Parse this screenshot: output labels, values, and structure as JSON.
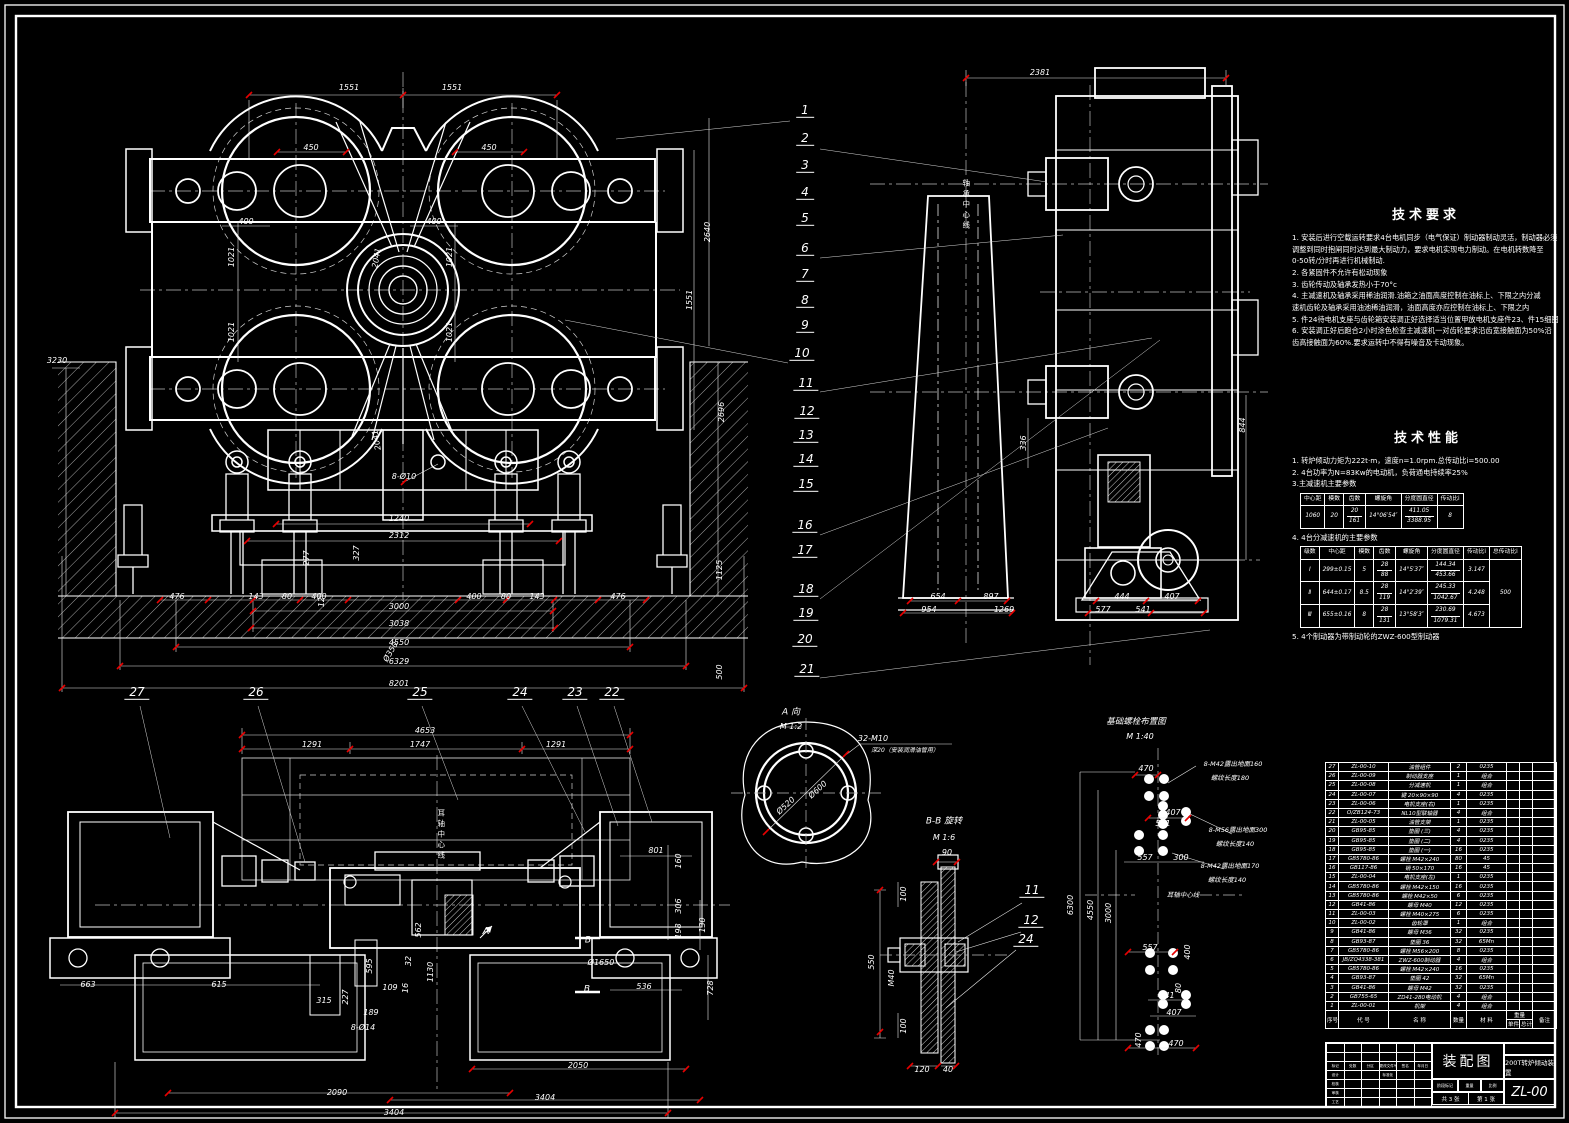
{
  "sheet": {
    "title": "装配图",
    "product": "200T转炉倾动装置",
    "code": "ZL-00",
    "sheet_count": "共 3 张",
    "sheet_no": "第 1 张"
  },
  "tech_requirements": {
    "title": "技术要求",
    "lines": [
      "1. 安装后进行空载运转要求4台电机同步（电气保证）制动器制动灵活，制动器必须",
      "    调整到同时抱闸同时达到最大制动力，要求电机实现电力制动。在电机转数降至",
      "      0-50转/分时再进行机械制动.",
      "2. 各紧固件不允许有松动现象",
      "3. 齿轮传动及轴承发热小于70°c",
      "4. 主减速机及轴承采用稀油润滑.油箱之油面高度控制在油标上、下限之内分减",
      "    速机齿轮及轴承采用油池稀油润滑，油面高度亦应控制在油标上、下限之内",
      "5. 件24待电机支座与齿轮箱安装调正好选择适当位置甲放电机支座件23、件15细图",
      "6. 安装调正好后跑合2小时涂色检查主减速机一对齿轮要求沿齿宽接触面为50%沿",
      "    齿高接触面为60%.要求运转中不得有噪音及卡动现象。"
    ]
  },
  "tech_performance": {
    "title": "技术性能",
    "line1": "1. 转炉倾动力矩为222t·m，速度n=1.0rpm.总传动比i=500.00",
    "line2": "2. 4台功率为N=83Kw的电动机，负荷通电持续率25%",
    "line3": "3.主减速机主要参数",
    "line4": "4. 4台分减速机的主要参数",
    "line5": "5. 4个制动器为带制动轮的ZWZ-600型制动器",
    "table1": {
      "h": [
        "中心距",
        "模数",
        "齿数",
        "螺旋角",
        "分度圆直径",
        "传动比i"
      ],
      "center": "1060",
      "module": "20",
      "teeth_top": "20",
      "teeth_bot": "161",
      "angle": "14°06′54″",
      "dia_top": "411.05",
      "dia_bot": "3388.95",
      "ratio": "8"
    },
    "table2": {
      "h": [
        "级数",
        "中心距",
        "模数",
        "齿数",
        "螺旋角",
        "分度圆直径",
        "传动比i",
        "总传动比i"
      ],
      "rows": [
        {
          "stage": "Ⅰ",
          "center": "299±0.15",
          "module": "5",
          "teeth_top": "28",
          "teeth_bot": "88",
          "angle": "14°5′37″",
          "dia_top": "144.34",
          "dia_bot": "453.66",
          "ratio": "3.147"
        },
        {
          "stage": "Ⅱ",
          "center": "644±0.17",
          "module": "8.5",
          "teeth_top": "28",
          "teeth_bot": "119",
          "angle": "14°2′39″",
          "dia_top": "245.33",
          "dia_bot": "1042.67",
          "ratio": "4.248"
        },
        {
          "stage": "Ⅲ",
          "center": "655±0.16",
          "module": "8",
          "teeth_top": "28",
          "teeth_bot": "131",
          "angle": "13°58′3″",
          "dia_top": "230.69",
          "dia_bot": "1079.31",
          "ratio": "4.673"
        }
      ],
      "total_ratio": "500"
    }
  },
  "labels": {
    "front": [
      {
        "t": "1551",
        "x": 349,
        "y": 88
      },
      {
        "t": "1551",
        "x": 452,
        "y": 88
      },
      {
        "t": "450",
        "x": 311,
        "y": 148
      },
      {
        "t": "450",
        "x": 489,
        "y": 148
      },
      {
        "t": "400",
        "x": 246,
        "y": 222
      },
      {
        "t": "400",
        "x": 434,
        "y": 222
      },
      {
        "t": "1021",
        "x": 232,
        "y": 257,
        "r": -90
      },
      {
        "t": "1021",
        "x": 450,
        "y": 257,
        "r": -90
      },
      {
        "t": "1021",
        "x": 232,
        "y": 332,
        "r": -90
      },
      {
        "t": "1021",
        "x": 450,
        "y": 332,
        "r": -90
      },
      {
        "t": "2041",
        "x": 377,
        "y": 258,
        "r": -80
      },
      {
        "t": "2041",
        "x": 377,
        "y": 440,
        "r": -100
      },
      {
        "t": "2640",
        "x": 708,
        "y": 232,
        "r": -90
      },
      {
        "t": "1551",
        "x": 690,
        "y": 300,
        "r": -90
      },
      {
        "t": "3230",
        "x": 57,
        "y": 361
      },
      {
        "t": "2696",
        "x": 722,
        "y": 412,
        "r": -90
      },
      {
        "t": "1125",
        "x": 720,
        "y": 570,
        "r": -90
      },
      {
        "t": "500",
        "x": 720,
        "y": 672,
        "r": -90
      },
      {
        "t": "8-Ø10",
        "x": 404,
        "y": 477
      },
      {
        "t": "327",
        "x": 357,
        "y": 553,
        "r": -90
      },
      {
        "t": "277",
        "x": 307,
        "y": 558,
        "r": -90
      },
      {
        "t": "12",
        "x": 322,
        "y": 602,
        "r": -90
      },
      {
        "t": "Ø350",
        "x": 391,
        "y": 652,
        "r": -60
      },
      {
        "t": "1240",
        "x": 399,
        "y": 519
      },
      {
        "t": "2312",
        "x": 399,
        "y": 536
      },
      {
        "t": "476",
        "x": 177,
        "y": 597
      },
      {
        "t": "143",
        "x": 256,
        "y": 597
      },
      {
        "t": "80",
        "x": 287,
        "y": 597
      },
      {
        "t": "400",
        "x": 319,
        "y": 597
      },
      {
        "t": "400",
        "x": 474,
        "y": 597
      },
      {
        "t": "80",
        "x": 506,
        "y": 597
      },
      {
        "t": "143",
        "x": 537,
        "y": 597
      },
      {
        "t": "476",
        "x": 618,
        "y": 597
      },
      {
        "t": "3000",
        "x": 399,
        "y": 607
      },
      {
        "t": "3038",
        "x": 399,
        "y": 624
      },
      {
        "t": "4550",
        "x": 399,
        "y": 643
      },
      {
        "t": "6329",
        "x": 399,
        "y": 662
      },
      {
        "t": "8201",
        "x": 399,
        "y": 684
      }
    ],
    "side": [
      {
        "t": "2381",
        "x": 1040,
        "y": 73
      },
      {
        "t": "轴承中心线",
        "x": 966,
        "y": 205,
        "v": 1
      },
      {
        "t": "336",
        "x": 1024,
        "y": 443,
        "r": -90
      },
      {
        "t": "844",
        "x": 1243,
        "y": 425,
        "r": -90
      },
      {
        "t": "654",
        "x": 938,
        "y": 597
      },
      {
        "t": "897",
        "x": 991,
        "y": 597
      },
      {
        "t": "954",
        "x": 929,
        "y": 610
      },
      {
        "t": "1269",
        "x": 1004,
        "y": 610
      },
      {
        "t": "444",
        "x": 1122,
        "y": 597
      },
      {
        "t": "407",
        "x": 1172,
        "y": 597
      },
      {
        "t": "577",
        "x": 1103,
        "y": 610
      },
      {
        "t": "541",
        "x": 1143,
        "y": 610
      }
    ],
    "plan": [
      {
        "t": "4653",
        "x": 425,
        "y": 731
      },
      {
        "t": "1291",
        "x": 312,
        "y": 745
      },
      {
        "t": "1747",
        "x": 420,
        "y": 745
      },
      {
        "t": "1291",
        "x": 556,
        "y": 745
      },
      {
        "t": "801",
        "x": 656,
        "y": 851
      },
      {
        "t": "耳轴中心线",
        "x": 441,
        "y": 835,
        "v": 1
      },
      {
        "t": "A",
        "x": 486,
        "y": 932,
        "s": 10
      },
      {
        "t": "B",
        "x": 588,
        "y": 941,
        "s": 9
      },
      {
        "t": "B",
        "x": 587,
        "y": 990,
        "s": 9
      },
      {
        "t": "160",
        "x": 679,
        "y": 861,
        "r": -90
      },
      {
        "t": "306",
        "x": 679,
        "y": 906,
        "r": -90
      },
      {
        "t": "198",
        "x": 679,
        "y": 931,
        "r": -90
      },
      {
        "t": "130",
        "x": 703,
        "y": 925,
        "r": -90
      },
      {
        "t": "728",
        "x": 711,
        "y": 988,
        "r": -90
      },
      {
        "t": "536",
        "x": 644,
        "y": 987
      },
      {
        "t": "Ø1650",
        "x": 601,
        "y": 963
      },
      {
        "t": "663",
        "x": 88,
        "y": 985
      },
      {
        "t": "615",
        "x": 219,
        "y": 985
      },
      {
        "t": "595",
        "x": 370,
        "y": 966,
        "r": -90
      },
      {
        "t": "315",
        "x": 324,
        "y": 1001
      },
      {
        "t": "227",
        "x": 346,
        "y": 997,
        "r": -90
      },
      {
        "t": "189",
        "x": 371,
        "y": 1013
      },
      {
        "t": "8-Ø14",
        "x": 363,
        "y": 1028
      },
      {
        "t": "109",
        "x": 390,
        "y": 988
      },
      {
        "t": "32",
        "x": 409,
        "y": 961,
        "r": -90
      },
      {
        "t": "16",
        "x": 406,
        "y": 988,
        "r": -90
      },
      {
        "t": "1130",
        "x": 431,
        "y": 972,
        "r": -90
      },
      {
        "t": "562",
        "x": 419,
        "y": 930,
        "r": -90
      },
      {
        "t": "2090",
        "x": 337,
        "y": 1093
      },
      {
        "t": "3404",
        "x": 394,
        "y": 1113
      },
      {
        "t": "2050",
        "x": 578,
        "y": 1066
      },
      {
        "t": "3404",
        "x": 545,
        "y": 1098
      }
    ],
    "aview": [
      {
        "t": "A 向",
        "x": 791,
        "y": 713,
        "s": 9
      },
      {
        "t": "M 1:2",
        "x": 791,
        "y": 727
      },
      {
        "t": "32-M10",
        "x": 873,
        "y": 739
      },
      {
        "t": "深20（安装润滑油管用）",
        "x": 905,
        "y": 751,
        "s": 6
      },
      {
        "t": "Ø520",
        "x": 786,
        "y": 806,
        "r": -42
      },
      {
        "t": "Ø600",
        "x": 818,
        "y": 790,
        "r": -42
      }
    ],
    "bb": [
      {
        "t": "B-B 旋转",
        "x": 944,
        "y": 822,
        "s": 9
      },
      {
        "t": "M 1:6",
        "x": 944,
        "y": 838
      },
      {
        "t": "90",
        "x": 947,
        "y": 853
      },
      {
        "t": "100",
        "x": 904,
        "y": 894,
        "r": -90
      },
      {
        "t": "550",
        "x": 872,
        "y": 962,
        "r": -90
      },
      {
        "t": "M40",
        "x": 892,
        "y": 978,
        "r": -90
      },
      {
        "t": "100",
        "x": 904,
        "y": 1026,
        "r": -90
      },
      {
        "t": "120",
        "x": 922,
        "y": 1070
      },
      {
        "t": "40",
        "x": 948,
        "y": 1070
      }
    ],
    "foundation": [
      {
        "t": "基础螺栓布置图",
        "x": 1136,
        "y": 722,
        "s": 8.5
      },
      {
        "t": "M 1:40",
        "x": 1140,
        "y": 737
      },
      {
        "t": "470",
        "x": 1146,
        "y": 769
      },
      {
        "t": "8-M42露出地面160",
        "x": 1233,
        "y": 764,
        "s": 6.5
      },
      {
        "t": "螺纹长度180",
        "x": 1230,
        "y": 778,
        "s": 6.5
      },
      {
        "t": "407",
        "x": 1173,
        "y": 813
      },
      {
        "t": "541",
        "x": 1163,
        "y": 824
      },
      {
        "t": "8-M56露出地面300",
        "x": 1238,
        "y": 830,
        "s": 6.5
      },
      {
        "t": "螺纹长度140",
        "x": 1235,
        "y": 844,
        "s": 6.5
      },
      {
        "t": "557",
        "x": 1145,
        "y": 858
      },
      {
        "t": "300",
        "x": 1181,
        "y": 858
      },
      {
        "t": "8-M42露出地面170",
        "x": 1230,
        "y": 866,
        "s": 6.5
      },
      {
        "t": "螺纹长度140",
        "x": 1227,
        "y": 880,
        "s": 6.5
      },
      {
        "t": "耳轴中心线",
        "x": 1183,
        "y": 895,
        "s": 6.5
      },
      {
        "t": "6300",
        "x": 1071,
        "y": 905,
        "r": -90
      },
      {
        "t": "4550",
        "x": 1091,
        "y": 910,
        "r": -90
      },
      {
        "t": "3000",
        "x": 1109,
        "y": 913,
        "r": -90
      },
      {
        "t": "557",
        "x": 1150,
        "y": 948
      },
      {
        "t": "400",
        "x": 1188,
        "y": 952,
        "r": -90
      },
      {
        "t": "80",
        "x": 1179,
        "y": 988,
        "r": -90
      },
      {
        "t": "541",
        "x": 1167,
        "y": 996
      },
      {
        "t": "407",
        "x": 1174,
        "y": 1013
      },
      {
        "t": "470",
        "x": 1139,
        "y": 1040,
        "r": -90
      },
      {
        "t": "470",
        "x": 1176,
        "y": 1044
      }
    ]
  },
  "callouts": {
    "main": [
      [
        1,
        805,
        118
      ],
      [
        2,
        805,
        146
      ],
      [
        3,
        805,
        173
      ],
      [
        4,
        805,
        200
      ],
      [
        5,
        805,
        226
      ],
      [
        6,
        805,
        256
      ],
      [
        7,
        805,
        282
      ],
      [
        8,
        805,
        308
      ],
      [
        9,
        805,
        333
      ],
      [
        10,
        802,
        361
      ],
      [
        11,
        806,
        391
      ],
      [
        12,
        807,
        419
      ],
      [
        13,
        806,
        443
      ],
      [
        14,
        806,
        467
      ],
      [
        15,
        806,
        492
      ],
      [
        16,
        805,
        533
      ],
      [
        17,
        805,
        558
      ],
      [
        18,
        806,
        597
      ],
      [
        19,
        806,
        621
      ],
      [
        20,
        805,
        647
      ],
      [
        21,
        807,
        677
      ]
    ],
    "plan": [
      [
        27,
        137,
        700
      ],
      [
        26,
        256,
        700
      ],
      [
        25,
        420,
        700
      ],
      [
        24,
        520,
        700
      ],
      [
        23,
        575,
        700
      ],
      [
        22,
        612,
        700
      ]
    ],
    "bb": [
      [
        11,
        1032,
        898
      ],
      [
        12,
        1031,
        928
      ],
      [
        24,
        1026,
        947
      ]
    ]
  },
  "bom": {
    "headers": {
      "no": "序号",
      "code": "代 号",
      "name": "名 称",
      "qty": "数量",
      "material": "材 料",
      "weight": "重量",
      "unit": "单件",
      "total": "总计",
      "remark": "备注"
    },
    "rows": [
      [
        "27",
        "ZL-00-10",
        "油管组件",
        "2",
        "0235"
      ],
      [
        "26",
        "ZL-00-09",
        "制动器支座",
        "1",
        "组合"
      ],
      [
        "25",
        "ZL-00-08",
        "分减速机",
        "1",
        "组合"
      ],
      [
        "24",
        "ZL-00-07",
        "键 20×90×90",
        "4",
        "0235"
      ],
      [
        "23",
        "ZL-00-06",
        "电机支座(右)",
        "1",
        "0235"
      ],
      [
        "22",
        "O/ZB124-73",
        "NL10型联轴器",
        "4",
        "组合"
      ],
      [
        "21",
        "ZL-00-05",
        "油管支架",
        "1",
        "0235"
      ],
      [
        "20",
        "GB95-85",
        "垫圈 (三)",
        "4",
        "0235"
      ],
      [
        "19",
        "GB95-85",
        "垫圈 (二)",
        "4",
        "0235"
      ],
      [
        "18",
        "GB95-85",
        "垫圈 (一)",
        "16",
        "0235"
      ],
      [
        "17",
        "GB5780-86",
        "螺栓 M42×240",
        "80",
        "45"
      ],
      [
        "16",
        "GB117-86",
        "销 50×170",
        "16",
        "45"
      ],
      [
        "15",
        "ZL-00-04",
        "电机支座(左)",
        "1",
        "0235"
      ],
      [
        "14",
        "GB5780-86",
        "螺栓 M42×150",
        "16",
        "0235"
      ],
      [
        "13",
        "GB5780-86",
        "螺栓 M42×50",
        "6",
        "0235"
      ],
      [
        "12",
        "GB41-86",
        "螺母 M40",
        "12",
        "0235"
      ],
      [
        "11",
        "ZL-00-03",
        "螺栓 M40×275",
        "6",
        "0235"
      ],
      [
        "10",
        "ZL-00-02",
        "齿轮罩",
        "1",
        "组合"
      ],
      [
        "9",
        "GB41-86",
        "螺母 M36",
        "32",
        "0235"
      ],
      [
        "8",
        "GB93-87",
        "垫圈 36",
        "32",
        "65Mn"
      ],
      [
        "7",
        "GB5780-86",
        "螺栓 M56×200",
        "8",
        "0235"
      ],
      [
        "6",
        "JB/ZQ4338-381",
        "ZWZ-600制动器",
        "4",
        "组合"
      ],
      [
        "5",
        "GB5780-86",
        "螺栓 M42×240",
        "16",
        "0235"
      ],
      [
        "4",
        "GB93-87",
        "垫圈 42",
        "32",
        "65Mn"
      ],
      [
        "3",
        "GB41-86",
        "螺母 M42",
        "32",
        "0235"
      ],
      [
        "2",
        "GB755-65",
        "ZD41-280电动机",
        "4",
        "组合"
      ],
      [
        "1",
        "ZL-00-01",
        "机架",
        "4",
        "组合"
      ]
    ]
  },
  "titleblock": {
    "rev_cols": [
      "标记",
      "处数",
      "分区",
      "更改文件号",
      "签名",
      "年月日"
    ],
    "roles": [
      "设计",
      "校核",
      "审核",
      "工艺"
    ],
    "std": "标准化",
    "stage": "阶段标记",
    "weight": "重量",
    "scale": "比例"
  }
}
